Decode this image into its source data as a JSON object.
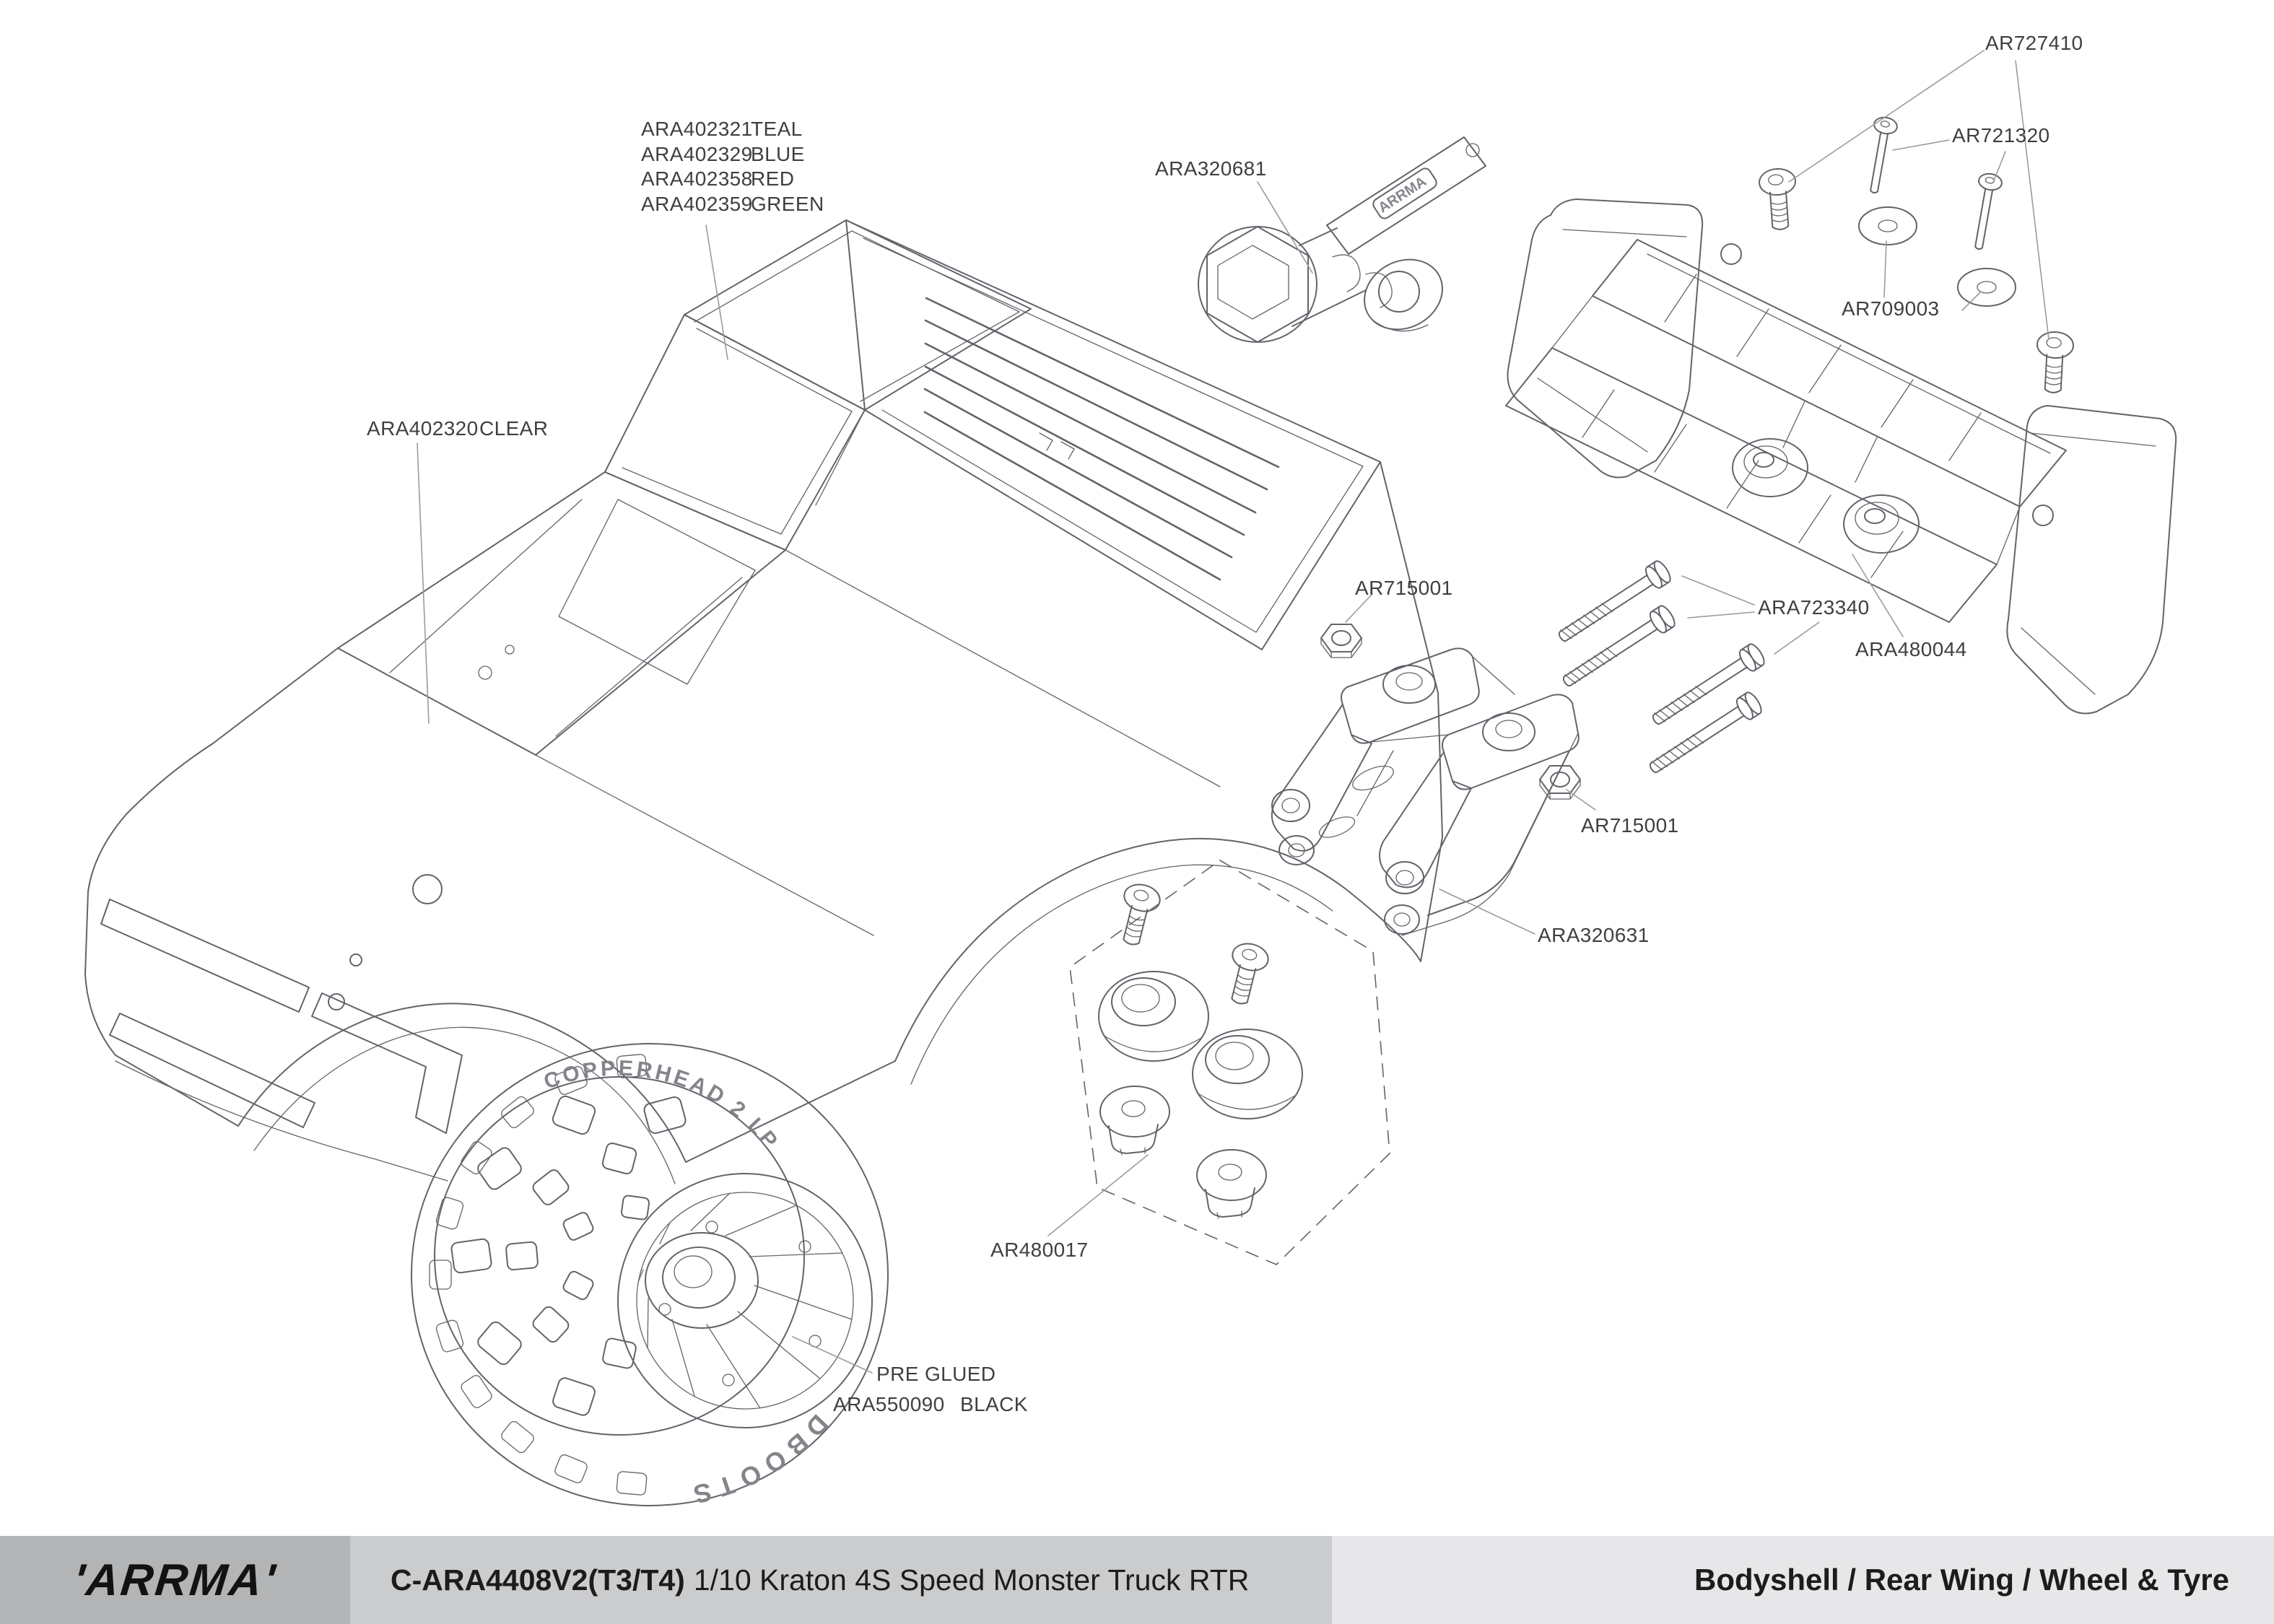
{
  "diagram": {
    "labels": {
      "body_color_options": {
        "rows": [
          {
            "part": "ARA402321",
            "color": "TEAL"
          },
          {
            "part": "ARA402329",
            "color": "BLUE"
          },
          {
            "part": "ARA402358",
            "color": "RED"
          },
          {
            "part": "ARA402359",
            "color": "GREEN"
          }
        ]
      },
      "tool": "ARA320681",
      "bodyshell_clear": {
        "part": "ARA402320",
        "color": "CLEAR"
      },
      "wing_button_screws": "AR727410",
      "wing_pins": "AR721320",
      "wing_washers": "AR709003",
      "nut_front": "AR715001",
      "wing_mount_screws": "ARA723340",
      "rear_wing": "ARA480044",
      "nut_rear": "AR715001",
      "wing_mount": "ARA320631",
      "body_mount_set": "AR480017",
      "tyre_note": "PRE GLUED",
      "wheel_tyre": {
        "part": "ARA550090",
        "color": "BLACK"
      }
    },
    "markings": {
      "tool_brand": "ARRMA",
      "tyre_model": "COPPERHEAD 2 LP",
      "tyre_brand": "DBOOTS"
    }
  },
  "footer": {
    "brand": "'ARRMA'",
    "doc_code": "C-ARA4408V2(T3/T4)",
    "doc_title": "1/10 Kraton 4S Speed Monster Truck RTR",
    "section": "Bodyshell / Rear Wing / Wheel & Tyre"
  },
  "colors": {
    "line": "#63646b",
    "leader_line": "#9a9b9f",
    "label_text": "#3f4043",
    "footer_left_bg": "#b3b4b6",
    "footer_mid_bg": "#cbccce",
    "footer_right_bg": "#e7e7e9",
    "footer_text": "#1d1b1c"
  }
}
